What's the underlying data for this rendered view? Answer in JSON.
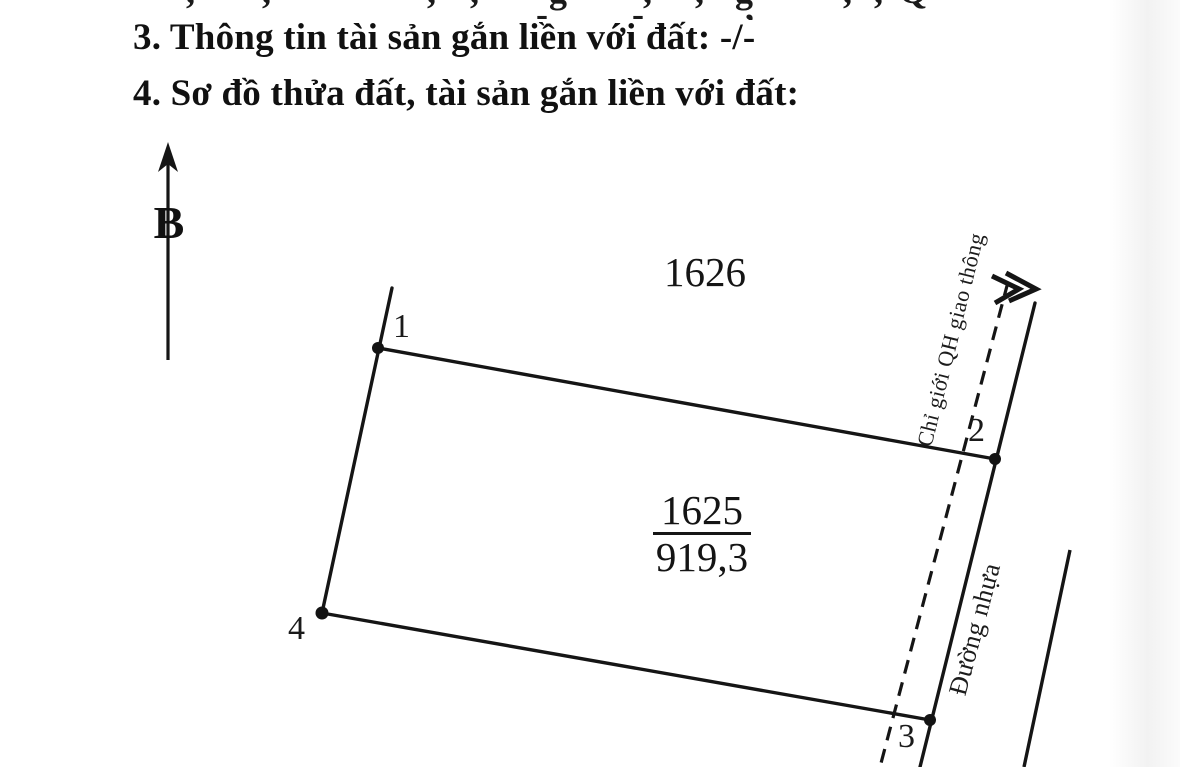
{
  "page": {
    "background": "#ffffff",
    "ink_color": "#151515"
  },
  "headings": {
    "section3": "3. Thông tin tài sản gắn liền với đất: -/-",
    "section4": "4. Sơ đồ thửa đất, tài sản gắn liền với đất:"
  },
  "top_fragment": {
    "glyphs": [
      {
        "x": 186,
        "c": ","
      },
      {
        "x": 262,
        "c": ","
      },
      {
        "x": 427,
        "c": ","
      },
      {
        "x": 470,
        "c": ","
      },
      {
        "x": 549,
        "c": "g"
      },
      {
        "x": 643,
        "c": ","
      },
      {
        "x": 695,
        "c": ","
      },
      {
        "x": 735,
        "c": "g"
      },
      {
        "x": 843,
        "c": ","
      },
      {
        "x": 874,
        "c": ","
      },
      {
        "x": 899,
        "c": "Q"
      },
      {
        "x": 536,
        "top": -4,
        "c": "-"
      },
      {
        "x": 632,
        "top": -4,
        "c": "-"
      },
      {
        "x": 745,
        "top": -10,
        "c": ","
      }
    ]
  },
  "diagram": {
    "north": {
      "label": "B"
    },
    "adjacent_parcel": {
      "number": "1626"
    },
    "parcel": {
      "number": "1625",
      "area": "919,3"
    },
    "corners": [
      {
        "label": "1"
      },
      {
        "label": "2"
      },
      {
        "label": "3"
      },
      {
        "label": "4"
      }
    ],
    "planning_line": {
      "label": "Chỉ giới QH giao thông"
    },
    "road": {
      "label": "Đường nhựa"
    }
  }
}
